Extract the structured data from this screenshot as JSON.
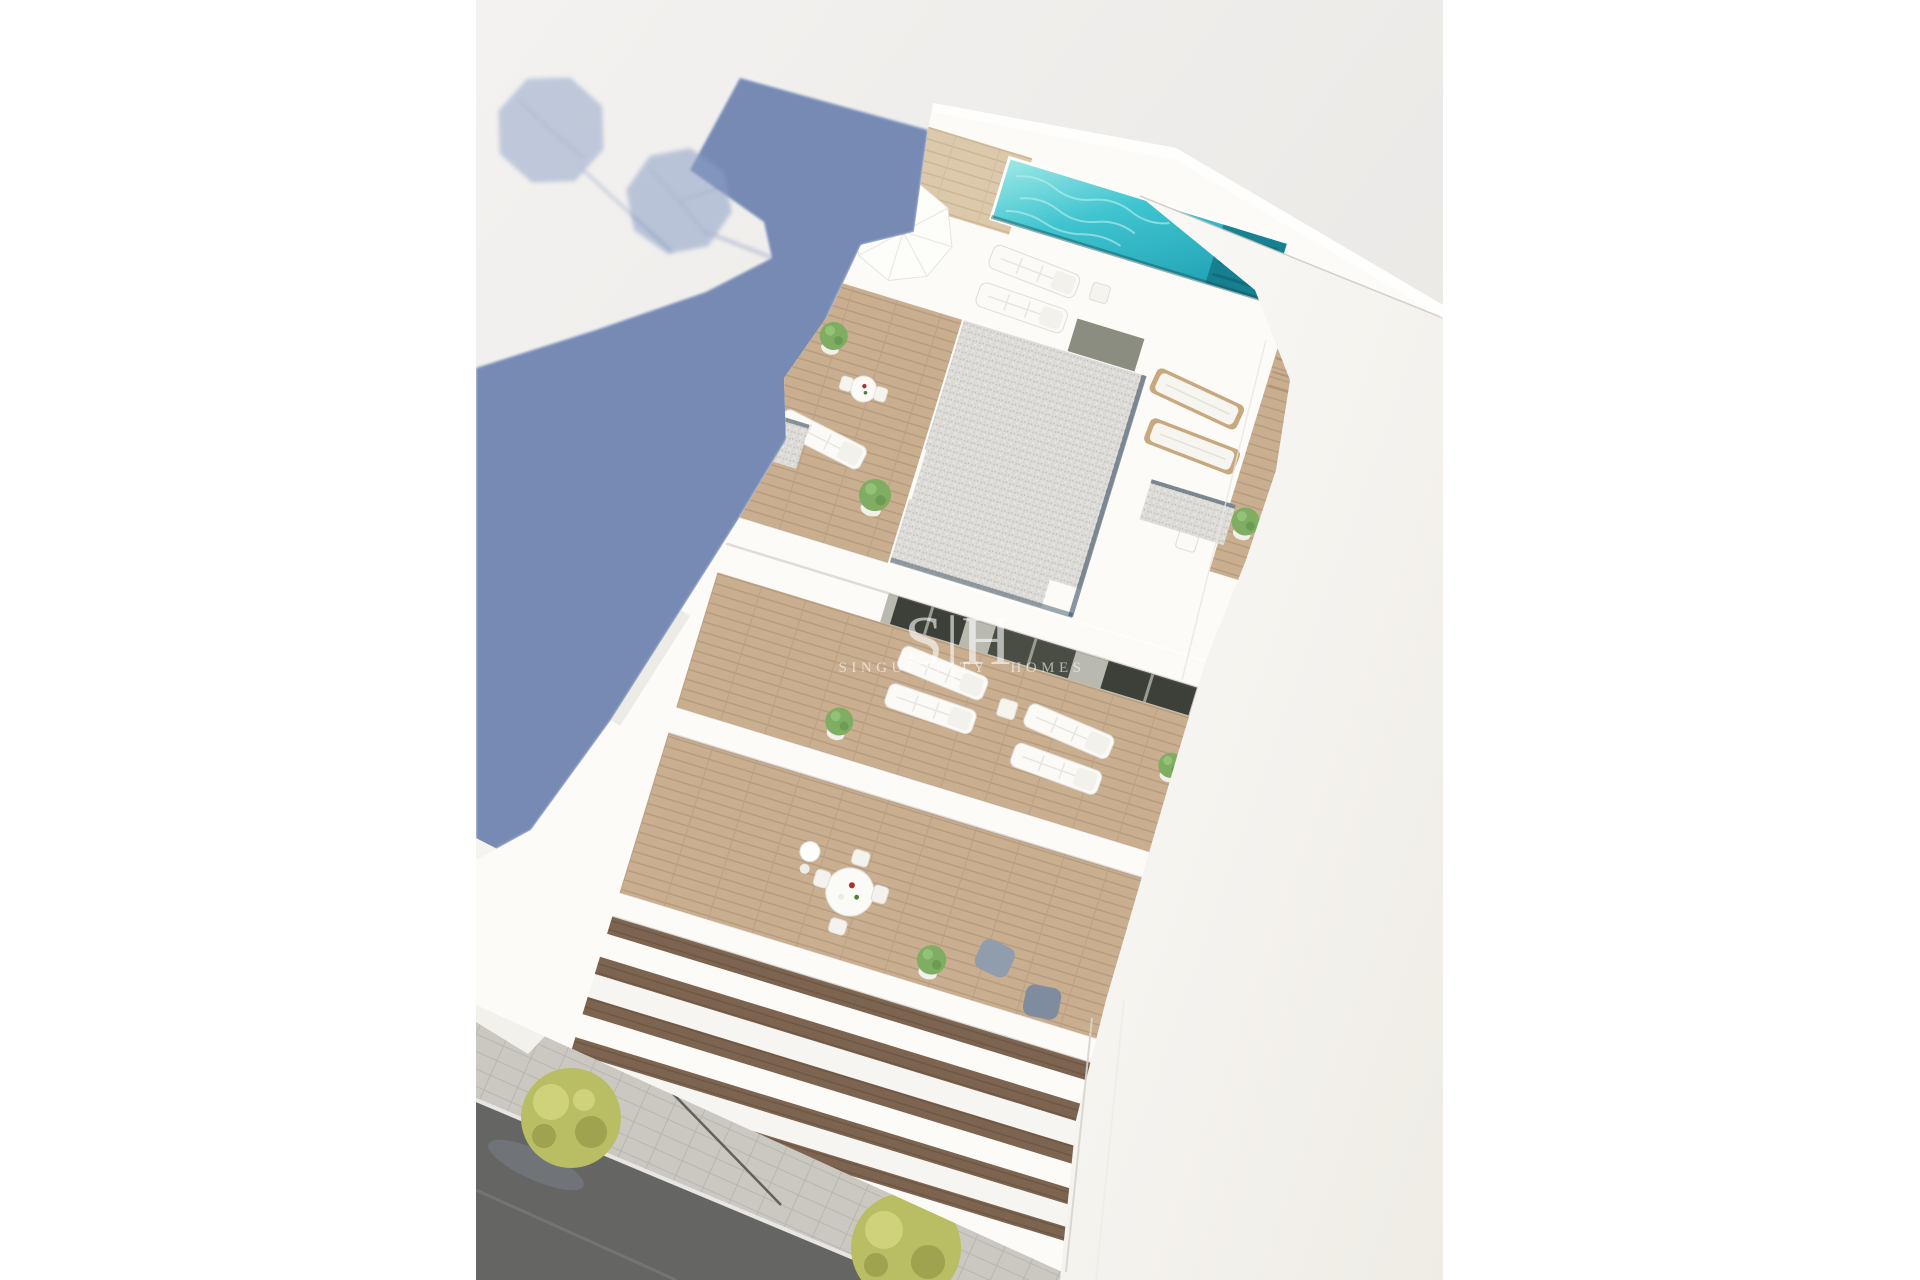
{
  "watermark": {
    "logo": "S|H",
    "name": "SINGULARITY HOMES"
  },
  "colors": {
    "ground_a": "#f3f1ef",
    "ground_b": "#e7e5e2",
    "shadow": "#7085b2",
    "shadow_light": "#8ba0c6",
    "pool_a": "#8fe6e4",
    "pool_b": "#2fb9c8",
    "pool_deep": "#147a8b",
    "wood": "#c9ae90",
    "wood_light": "#dcc8ab",
    "wood_dark": "#7d6450",
    "gravel": "#dedcd8",
    "white_wall": "#fcfbf8",
    "wall_shade": "#edebe5",
    "facade_a": "#fbfaf7",
    "facade_b": "#f0ede7",
    "road": "#656663",
    "sidewalk": "#cbc8c2",
    "curb": "#e8e6e2",
    "tree": "#b9bd63",
    "tree_dark": "#9fa34f",
    "tree_light": "#cfd27a",
    "plant": "#7fae63",
    "door_dark": "#3d4038",
    "lounger_frame": "#c7a87f",
    "slot_navy": "#2b4257",
    "chair_gray": "#909dad"
  },
  "scene": {
    "elements": [
      "building-shadow",
      "umbrella-shadow",
      "rooftop-pool",
      "pool-deck",
      "sun-umbrella",
      "sun-loungers",
      "gravel-roof",
      "wood-terrace",
      "round-dining-table",
      "balconies",
      "street",
      "sidewalk",
      "trees",
      "street-lamp",
      "right-facade",
      "neighbor-building"
    ]
  }
}
